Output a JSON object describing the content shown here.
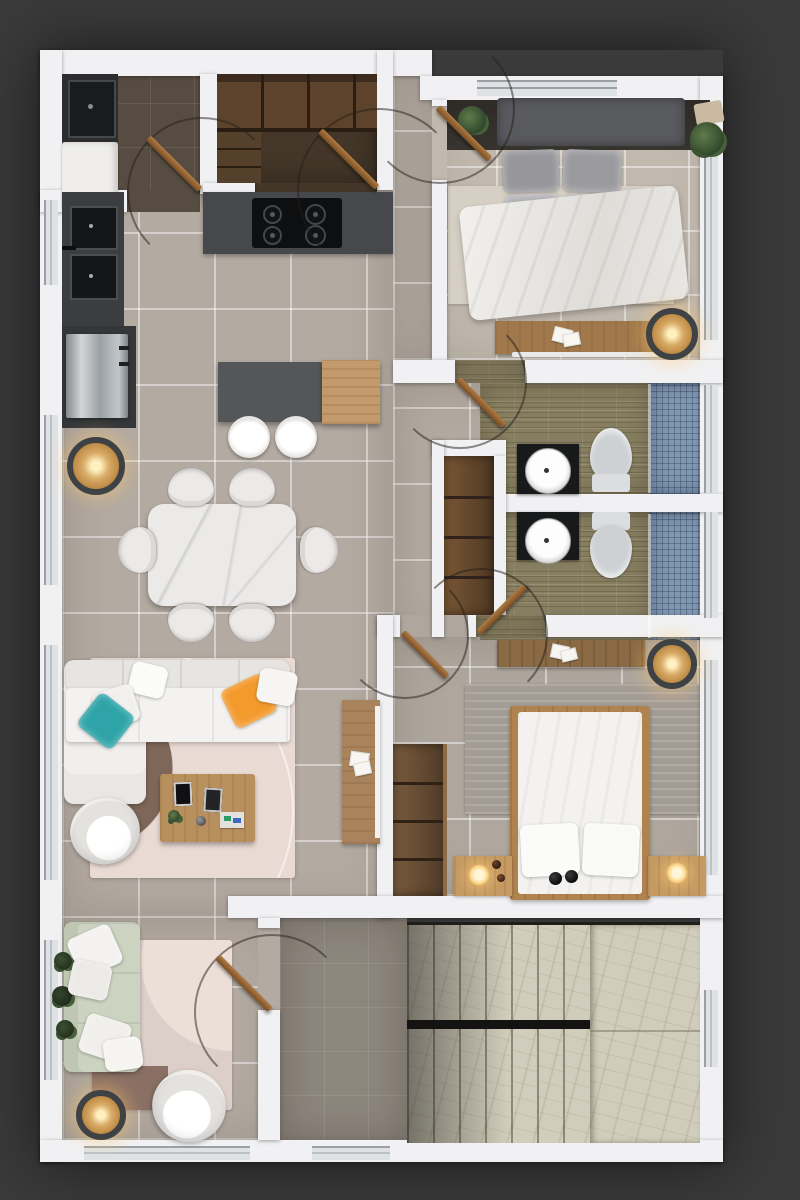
{
  "meta": {
    "title": "Apartment floor plan — photorealistic top-down 3D render",
    "view": "top-down",
    "text_visible": "none"
  },
  "palette": {
    "bg": "#3a3a3a",
    "wall": "#f1f1f3",
    "grout": "rgba(255,255,255,0.45)",
    "floorMain": "#b3aaa1",
    "floorBed1": "#c1b9ae",
    "floorBed2": "#afa79e",
    "floorLaundry": "#574c41",
    "floorPantry": "#443729",
    "floorHall": "#8d867d",
    "oliveTile": "#877e60",
    "mosaic": "#8097b1",
    "marble": "#d1cdbc",
    "window": "#dfe2e5",
    "windowFrame": "#9aa0a5",
    "doorWood": "#9c6b42",
    "counterKitchen": "#46484b",
    "counterBlack": "#17191a",
    "island": "#54575a",
    "islandWood": "#c39a6c",
    "fridgeSteel": "#aeb3b7",
    "shelfWood": "#6b4d31",
    "nightWood": "#c59a63",
    "deskWood": "#a0784b",
    "bedFrameWood": "#b0824e",
    "sofaWhite": "#f3f2f0",
    "sofaGreen": "#ccd3c1",
    "tealPillow": "#2ea4a8",
    "orangePillow": "#f39a2d",
    "rugLiving": "#e9dad4",
    "rugArcBrown": "#7e6759",
    "rugBed1": "#d6cfc4",
    "rugBed2": "#a49d95",
    "rugLounge": "#dccec8",
    "tableMarble": "#eceae8",
    "headboard": "#595a5e",
    "headboardBand": "#37342f",
    "toilet": "#ced1d4",
    "basketRing": "#3f4245",
    "weave": "#d8ab67",
    "lampGlow": "#ffd27e"
  },
  "rooms": [
    {
      "id": "laundry",
      "name": "Laundry room",
      "furniture": [
        "dark counter with sink",
        "washing machine"
      ]
    },
    {
      "id": "pantry",
      "name": "Pantry closet",
      "furniture": [
        "wall shelving",
        "side shelves"
      ]
    },
    {
      "id": "bedroom-1",
      "name": "Bedroom 1",
      "furniture": [
        "double bed with gray pillows",
        "dark headboard wall",
        "two nightstands with plants",
        "beige area rug",
        "desk with papers",
        "woven basket lamp"
      ]
    },
    {
      "id": "kitchen",
      "name": "Kitchen",
      "furniture": [
        "gas stove countertop",
        "double sink counter",
        "stainless refrigerator",
        "island with wood top",
        "two bar stools",
        "woven pendant lamp"
      ]
    },
    {
      "id": "dining",
      "name": "Dining area",
      "furniture": [
        "white marble table",
        "six white chairs"
      ]
    },
    {
      "id": "bathroom-1",
      "name": "Bathroom 1",
      "furniture": [
        "black vanity with white sink",
        "toilet",
        "blue mosaic shower",
        "wooden linen niche"
      ]
    },
    {
      "id": "bathroom-2",
      "name": "Bathroom 2",
      "furniture": [
        "black vanity with white sink",
        "toilet",
        "blue mosaic shower"
      ]
    },
    {
      "id": "living",
      "name": "Living room",
      "furniture": [
        "white L-shaped sofa",
        "teal pillow",
        "orange pillow",
        "white swivel armchair",
        "wooden coffee table with frames",
        "rug with brown arc",
        "media console with papers"
      ]
    },
    {
      "id": "bedroom-2",
      "name": "Bedroom 2",
      "furniture": [
        "wood-frame double bed",
        "two nightstands with glowing lamps",
        "striped gray rug",
        "desk with papers",
        "open shelf unit",
        "woven basket lamp"
      ]
    },
    {
      "id": "lounge",
      "name": "Lounge sitting room",
      "furniture": [
        "sage green sofa with white pillows",
        "plant",
        "layered pink rug",
        "white swivel armchair",
        "woven basket floor lamp"
      ]
    },
    {
      "id": "stair-hall",
      "name": "Stair hall",
      "furniture": []
    },
    {
      "id": "stairs",
      "name": "U-shaped marble staircase",
      "furniture": [
        "upper flight of 7 steps",
        "landing",
        "lower flight of 7 steps"
      ]
    }
  ],
  "doors": [
    "laundry",
    "pantry",
    "bedroom-1",
    "bathroom-1",
    "bathroom-2",
    "bedroom-2",
    "lounge"
  ],
  "windows": [
    "left-kitchen",
    "left-dining",
    "left-living",
    "left-lounge",
    "top-bedroom-1",
    "right-bedroom-1",
    "right-bathroom-1",
    "right-bathroom-2",
    "right-bedroom-2",
    "right-stairs",
    "bottom-lounge",
    "bottom-hall"
  ]
}
